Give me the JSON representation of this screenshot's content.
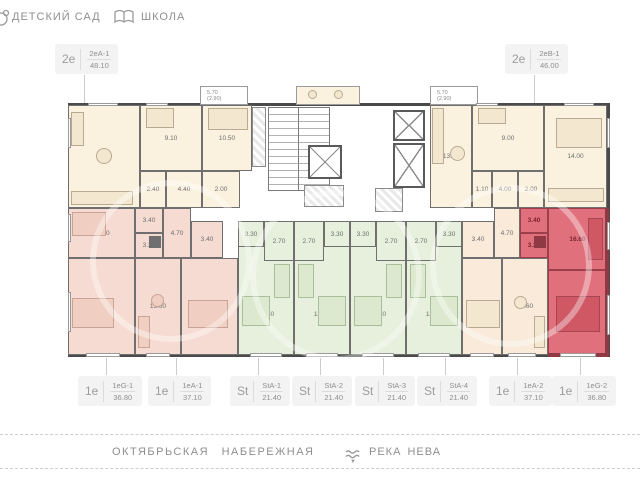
{
  "header": {
    "kindergarten_label": "ДЕТСКИЙ САД",
    "school_label": "ШКОЛА"
  },
  "footer": {
    "street_label": "ОКТЯБРЬСКАЯ НАБЕРЕЖНАЯ",
    "river_label": "РЕКА НЕВА"
  },
  "selected_apartment": "1еG-2",
  "colors": {
    "selected_fill": "#e0707b",
    "selected_wall": "#9c3f4b",
    "two_room_fill": "#fbf1df",
    "one_room_left_fill": "#f5dbd1",
    "studio_fill": "#e7efdd",
    "one_room_right_fill": "#f9ead9",
    "walls": "#4a4a4a",
    "label_gray": "#8f8f8f"
  },
  "apartments": [
    {
      "id": "2eA-1",
      "type_label": "2е",
      "code": "2еА-1",
      "total_area": "48.10",
      "rooms": [
        "14.80",
        "9.10",
        "10.50",
        "2.40",
        "4.40",
        "2.00"
      ],
      "balcony": {
        "area": "5.70",
        "half": "(2.90)"
      }
    },
    {
      "id": "2eB-1",
      "type_label": "2е",
      "code": "2еВ-1",
      "total_area": "46.00",
      "rooms": [
        "13.00",
        "9.00",
        "14.00",
        "1.10",
        "4.00",
        "2.00"
      ],
      "balcony": {
        "area": "5.70",
        "half": "(2.90)"
      }
    },
    {
      "id": "1eG-1",
      "type_label": "1е",
      "code": "1еG-1",
      "total_area": "36.80",
      "rooms": [
        "16.60",
        "3.40",
        "3.20",
        "13.60"
      ]
    },
    {
      "id": "1eA-1",
      "type_label": "1е",
      "code": "1еА-1",
      "total_area": "37.10",
      "rooms": [
        "4.70",
        "3.40",
        "15.60",
        "13.40"
      ]
    },
    {
      "id": "StA-1",
      "type_label": "St",
      "code": "StA-1",
      "total_area": "21.40",
      "rooms": [
        "3.30",
        "2.70",
        "15.40"
      ]
    },
    {
      "id": "StA-2",
      "type_label": "St",
      "code": "StA-2",
      "total_area": "21.40",
      "rooms": [
        "3.30",
        "2.70",
        "15.40"
      ]
    },
    {
      "id": "StA-3",
      "type_label": "St",
      "code": "StA-3",
      "total_area": "21.40",
      "rooms": [
        "3.30",
        "2.70",
        "15.40"
      ]
    },
    {
      "id": "StA-4",
      "type_label": "St",
      "code": "StA-4",
      "total_area": "21.40",
      "rooms": [
        "3.30",
        "2.70",
        "15.40"
      ]
    },
    {
      "id": "1eA-2",
      "type_label": "1е",
      "code": "1еА-2",
      "total_area": "37.10",
      "rooms": [
        "3.40",
        "4.70",
        "13.40",
        "15.60"
      ]
    },
    {
      "id": "1eG-2",
      "type_label": "1е",
      "code": "1еG-2",
      "total_area": "36.80",
      "rooms": [
        "3.40",
        "3.20",
        "16.60",
        "13.60"
      ],
      "selected": true
    }
  ]
}
